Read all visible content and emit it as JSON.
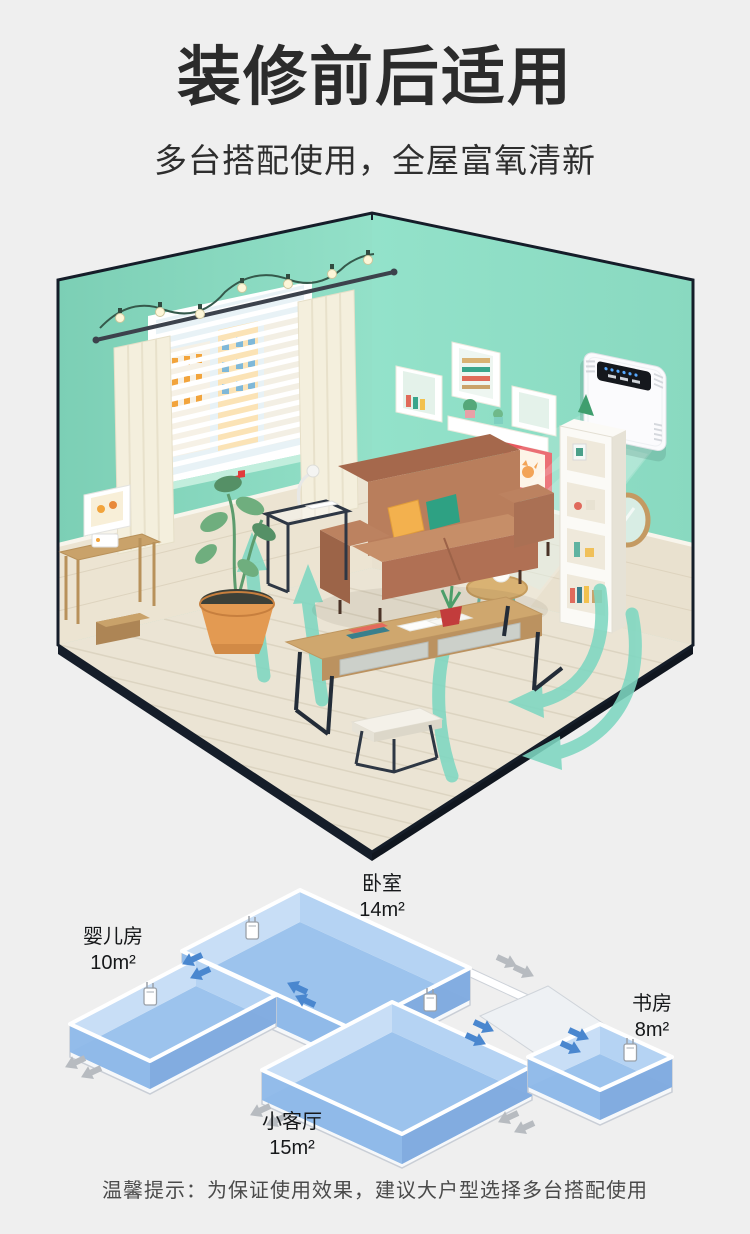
{
  "header": {
    "title": "装修前后适用",
    "subtitle": "多台搭配使用，全屋富氧清新"
  },
  "scene": {
    "device": "wall-mounted-fresh-air-purifier",
    "airflow": "fresh-air-circulation-arrows"
  },
  "floor_plan": {
    "rooms": [
      {
        "id": "baby-room",
        "name": "婴儿房",
        "area": "10m²"
      },
      {
        "id": "bedroom",
        "name": "卧室",
        "area": "14m²"
      },
      {
        "id": "living-room",
        "name": "小客厅",
        "area": "15m²"
      },
      {
        "id": "study",
        "name": "书房",
        "area": "8m²"
      }
    ]
  },
  "footer": {
    "tip": "温馨提示：为保证使用效果，建议大户型选择多台搭配使用"
  },
  "colors": {
    "background": "#efefef",
    "title": "#2b2b2b",
    "wall_mint": "#8bdac1",
    "airflow_teal": "#7ed7c1",
    "floorplan_room_blue": "#9cc3ed",
    "arrow_in_blue": "#4a87cf",
    "arrow_out_gray": "#b7bbc0"
  }
}
